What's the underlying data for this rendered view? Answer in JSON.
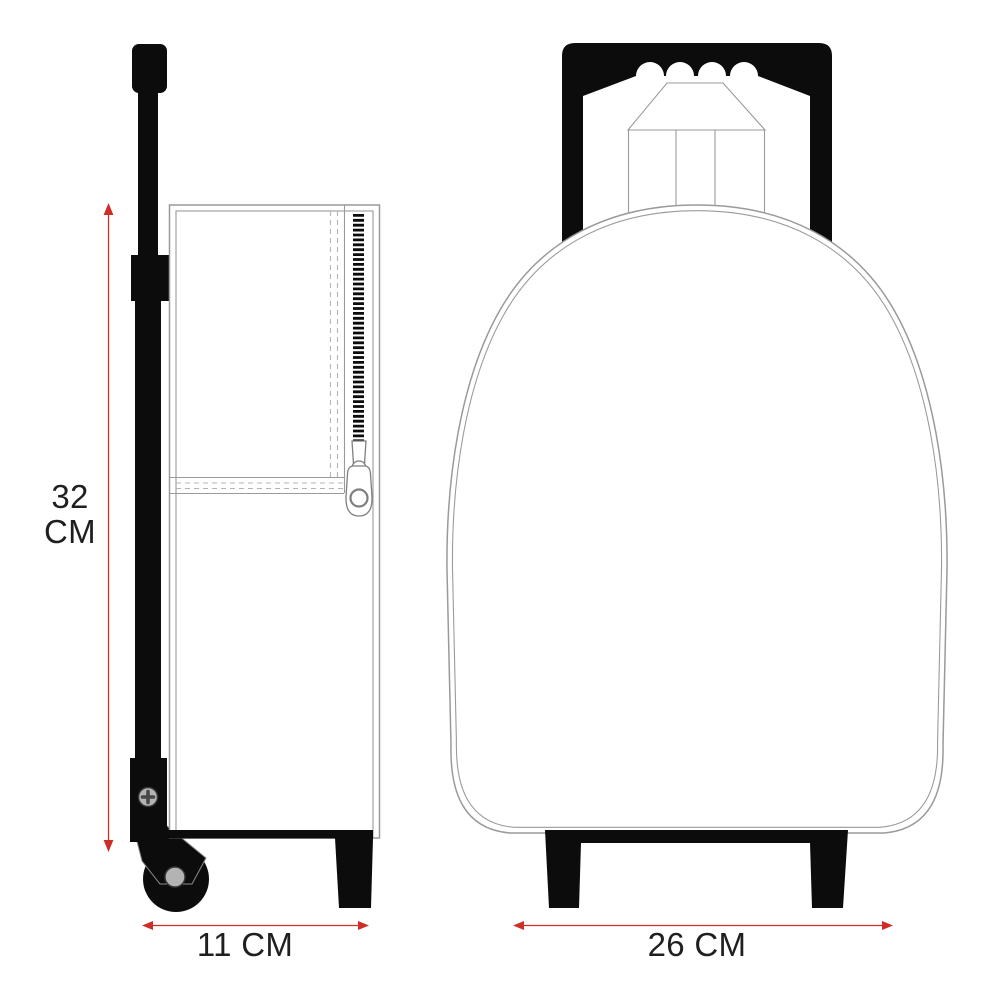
{
  "colors": {
    "ink": "#0c0c0c",
    "outline": "#9a9a9a",
    "stitch": "#b4b4b4",
    "accent": "#cf2e28",
    "text": "#1f1f1f",
    "metal": "#b3b3b3",
    "background": "#ffffff"
  },
  "dimensions": {
    "height": {
      "value": "32",
      "unit": "CM"
    },
    "depth": {
      "label": "11 CM"
    },
    "width": {
      "label": "26 CM"
    }
  }
}
